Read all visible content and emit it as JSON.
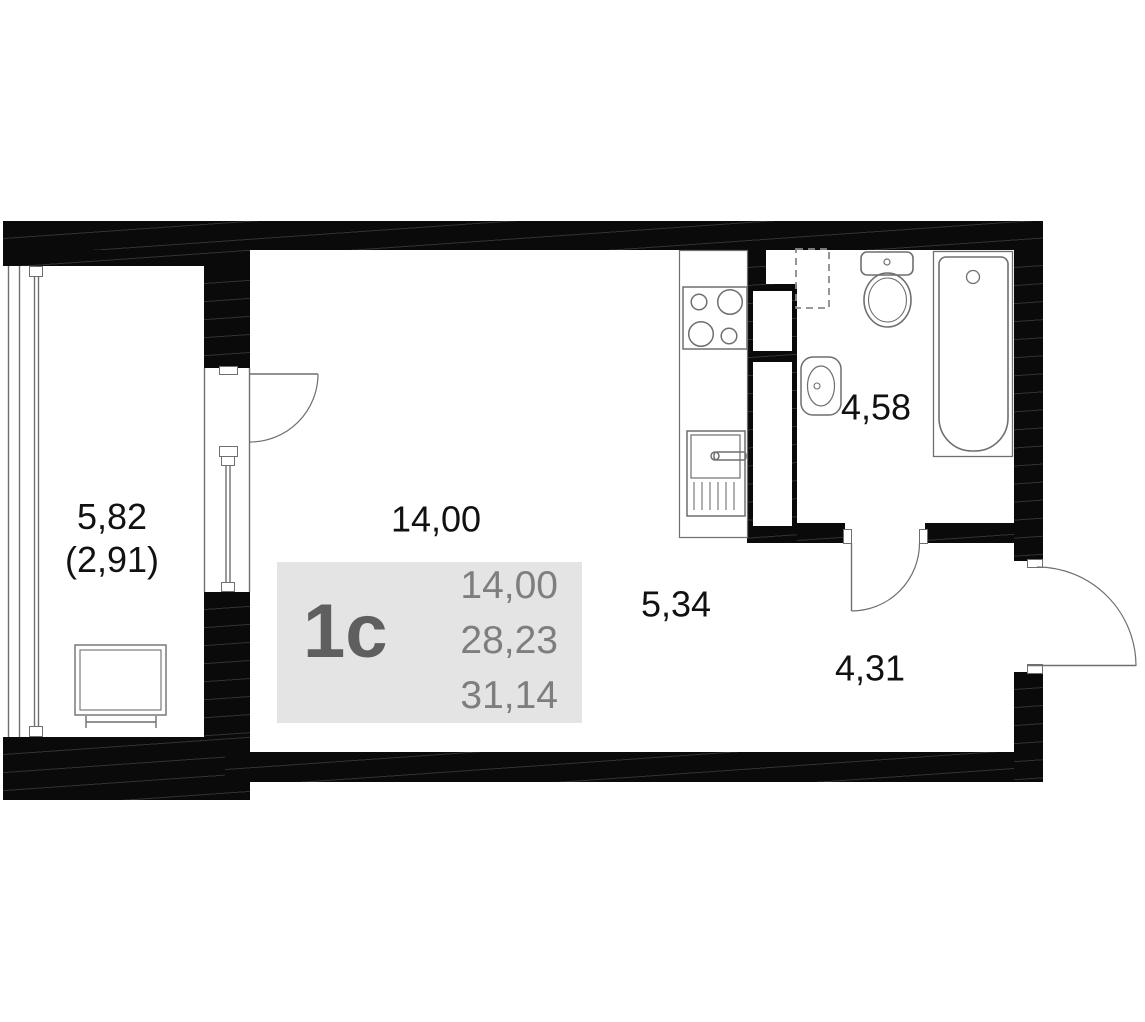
{
  "unit_card": {
    "unit_type": "1с",
    "living_area": "14,00",
    "floor_area": "28,23",
    "total_area": "31,14"
  },
  "room_labels": {
    "balcony": "5,82",
    "balcony_reduced": "(2,91)",
    "living_room": "14,00",
    "kitchen_zone": "5,34",
    "hallway": "4,31",
    "bathroom": "4,58"
  },
  "colors": {
    "background": "#ffffff",
    "wall": "#0a0a0a",
    "thin_line": "#6f6f6f",
    "dashed_line": "#8a8a8a",
    "card_bg": "#e4e4e4",
    "card_unit_text": "#5f5f5f",
    "card_number_text": "#7e7e7e",
    "label_text": "#111111"
  }
}
